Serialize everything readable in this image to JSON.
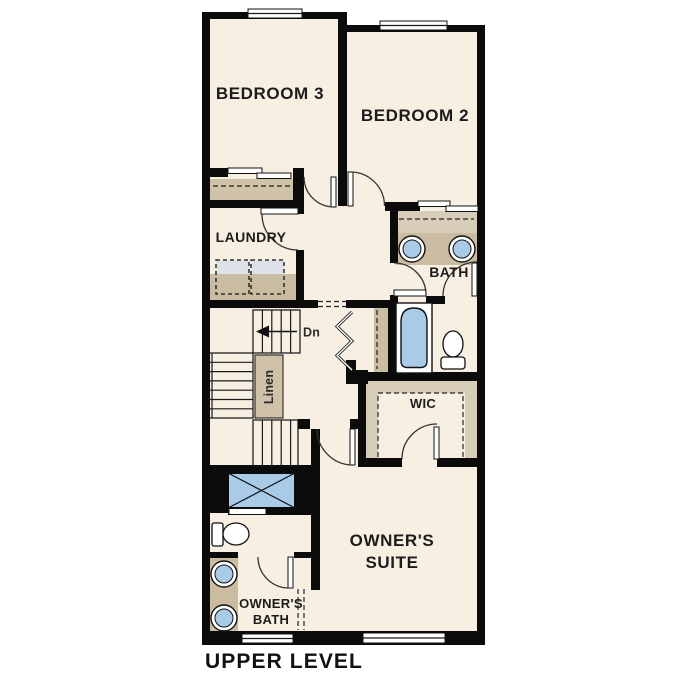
{
  "plan": {
    "title": "UPPER LEVEL",
    "level": "upper",
    "labels": {
      "bedroom3": "BEDROOM 3",
      "bedroom2": "BEDROOM 2",
      "laundry": "LAUNDRY",
      "bath": "BATH",
      "wic": "WIC",
      "owners_suite_1": "OWNER'S",
      "owners_suite_2": "SUITE",
      "owners_bath_1": "OWNER'S",
      "owners_bath_2": "BATH",
      "linen": "Linen",
      "down": "Dn"
    }
  },
  "colors": {
    "floor": "#f7efe1",
    "wall": "#0b0b0b",
    "line": "#1a1a1a",
    "counter": "#c9bca1",
    "shelf": "#cfc2a9",
    "shelf_light": "#d8cdb8",
    "fixture_blue": "#a9cbe8",
    "appliance_top": "#dce2e7",
    "text": "#1c1c1c"
  }
}
